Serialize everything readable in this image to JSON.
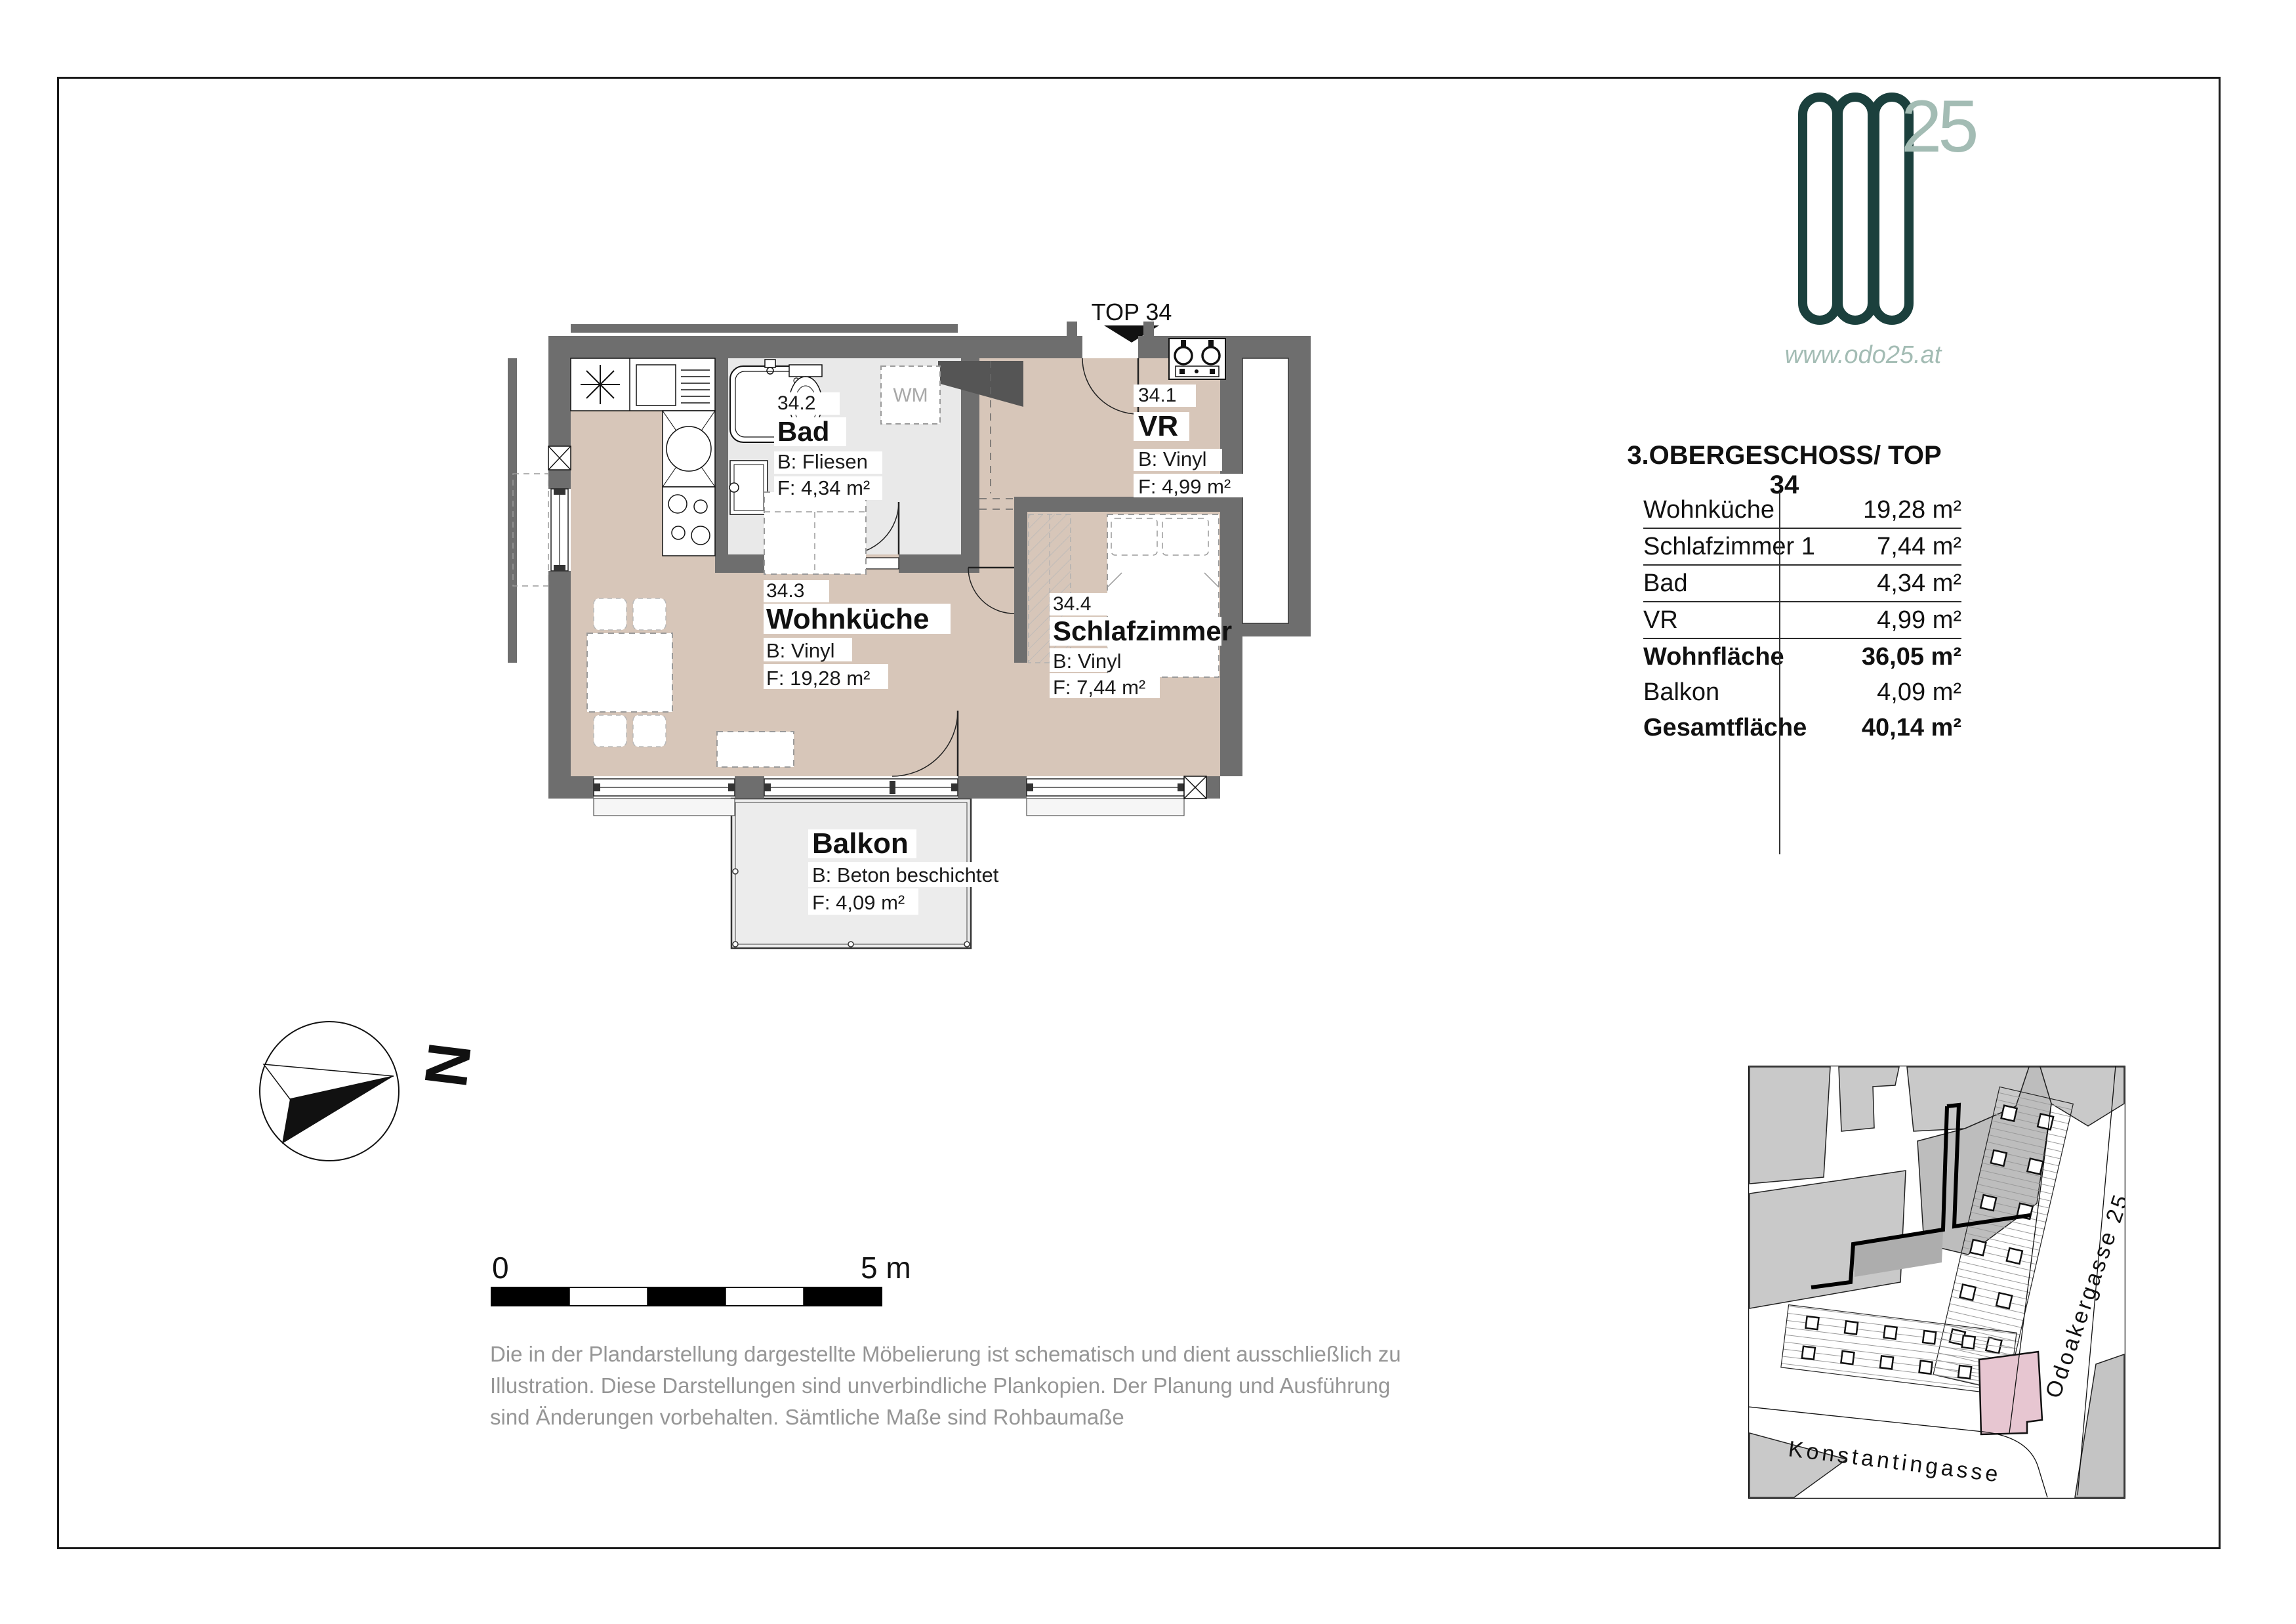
{
  "logo": {
    "brand": "ODO",
    "number": "25",
    "website": "www.odo25.at"
  },
  "unit_title": "3.OBERGESCHOSS/ TOP 34",
  "table": {
    "rows": [
      {
        "label": "Wohnküche",
        "value": "19,28 m²"
      },
      {
        "label": "Schlafzimmer 1",
        "value": "7,44 m²"
      },
      {
        "label": "Bad",
        "value": "4,34 m²"
      },
      {
        "label": "VR",
        "value": "4,99 m²"
      },
      {
        "label": "Wohnfläche",
        "value": "36,05 m²"
      },
      {
        "label": "Balkon",
        "value": "4,09 m²"
      },
      {
        "label": "Gesamtfläche",
        "value": "40,14 m²"
      }
    ]
  },
  "plan": {
    "top_label": "TOP 34",
    "washer_label": "WM",
    "rooms": {
      "vr": {
        "number": "34.1",
        "name": "VR",
        "floor": "B: Vinyl",
        "area": "F: 4,99 m²"
      },
      "bad": {
        "number": "34.2",
        "name": "Bad",
        "floor": "B: Fliesen",
        "area": "F: 4,34 m²"
      },
      "wohnkueche": {
        "number": "34.3",
        "name": "Wohnküche",
        "floor": "B: Vinyl",
        "area": "F: 19,28 m²"
      },
      "schlafzimmer": {
        "number": "34.4",
        "name": "Schlafzimmer",
        "floor": "B: Vinyl",
        "area": "F: 7,44 m²"
      },
      "balkon": {
        "name": "Balkon",
        "floor": "B: Beton beschichtet",
        "area": "F: 4,09 m²"
      }
    }
  },
  "compass": {
    "north_label": "N"
  },
  "scalebar": {
    "start": "0",
    "end": "5 m"
  },
  "disclaimer": {
    "line1": "Die in der Plandarstellung dargestellte Möbelierung ist schematisch und dient ausschließlich zu",
    "line2": "Illustration. Diese Darstellungen sind unverbindliche Plankopien. Der Planung und Ausführung",
    "line3": "sind Änderungen vorbehalten. Sämtliche Maße sind Rohbaumaße"
  },
  "sitemap": {
    "street_bottom": "Konstantingasse",
    "street_right": "Odoakergasse 25"
  },
  "colors": {
    "logo_dark": "#1b403d",
    "logo_light": "#a3bcb4",
    "wall_gray": "#6e6e6e",
    "floor_beige": "#d7c6b9",
    "highlight_pink": "#e7c6d1"
  }
}
